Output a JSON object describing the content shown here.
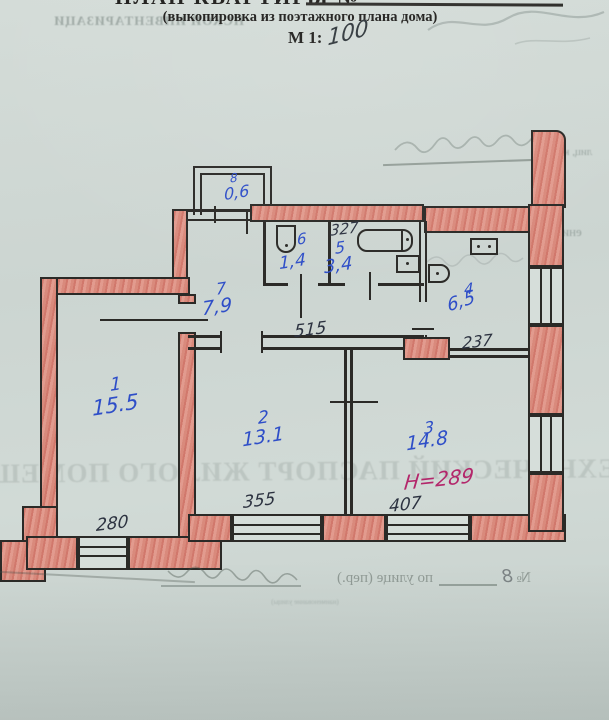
{
  "header": {
    "title": "ПЛАН КВАРТИРЫ №",
    "subtitle": "(выкопировка из поэтажного плана дома)",
    "scale_label": "М 1:",
    "scale_value": "100"
  },
  "rooms": [
    {
      "number": "1",
      "area": "15.5"
    },
    {
      "number": "2",
      "area": "13.1"
    },
    {
      "number": "3",
      "area": "14.8"
    },
    {
      "number": "4",
      "area": "6,5"
    },
    {
      "number": "5",
      "area": "3,4"
    },
    {
      "number": "6",
      "area": "1,4"
    },
    {
      "number": "7",
      "area": "7,9"
    },
    {
      "number": "8",
      "area": "0,6"
    }
  ],
  "dimensions": {
    "bath": "327",
    "hall": "515",
    "kitchen": "237",
    "room1": "280",
    "room2": "355",
    "room3": "407"
  },
  "annotations": {
    "red_note": "Н=289"
  },
  "bleed": {
    "top_left": "НСКОЙ ИНВЕНТАРИЗАЦИ",
    "big_line": "ТЕХНИЧЕСКИЙ ПАСПОРТ ЖИЛОГО ПОМЕЩЕНИ",
    "right_frag1": "лиц, кварт",
    "right_frag2": "ение)",
    "bottom_no": "№",
    "bottom_no_value": "8",
    "bottom_street": "по улице (пер.)",
    "bottom_caption": "(наименование улицы)"
  },
  "colors": {
    "paper": "#ced7d3",
    "ink": "#2b2a27",
    "wall_red": "#dc9488",
    "blue_pen": "#2e4ec8",
    "red_pen": "#b3276b"
  }
}
